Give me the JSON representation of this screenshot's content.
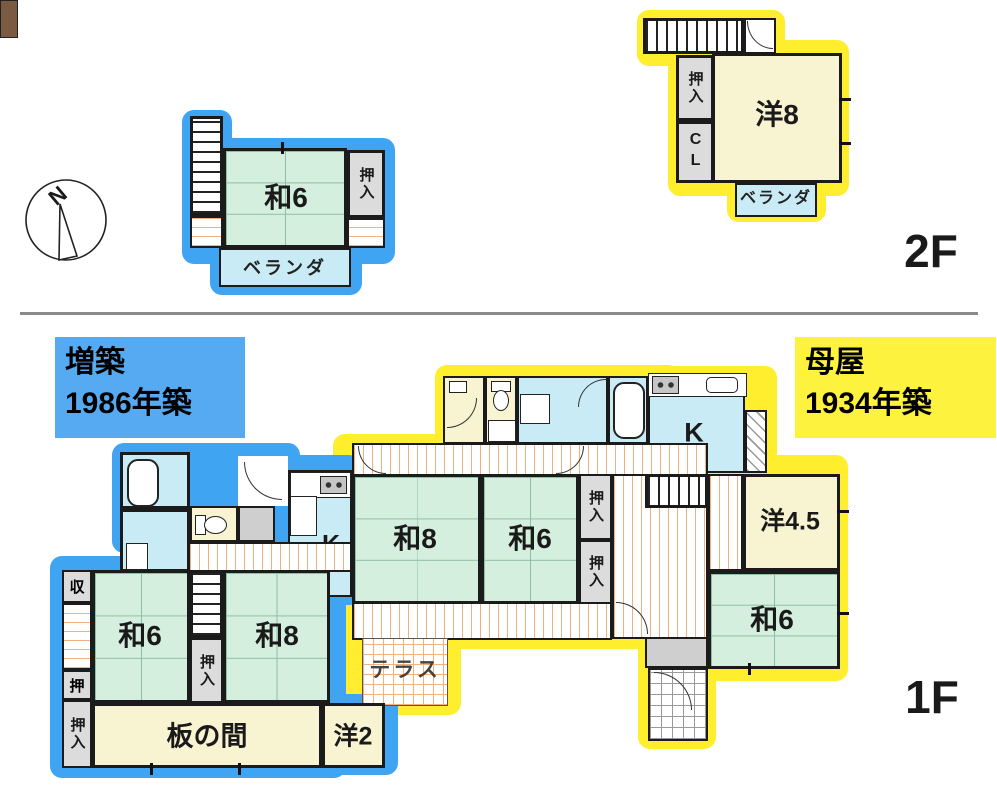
{
  "compass": {
    "north": "N"
  },
  "labels": {
    "floor2": "2F",
    "floor1": "1F"
  },
  "annotations": {
    "extension_line1": "増築",
    "extension_line2": "1986年築",
    "main_line1": "母屋",
    "main_line2": "1934年築"
  },
  "floor2": {
    "blue": {
      "room": "和6",
      "closet": "押入",
      "veranda": "ベランダ"
    },
    "yellow": {
      "room": "洋8",
      "closet": "押入",
      "cl": "CL",
      "veranda": "ベランダ"
    }
  },
  "floor1": {
    "blue": {
      "k": "K",
      "wa6": "和6",
      "wa8": "和8",
      "itanoma": "板の間",
      "yo2": "洋2",
      "shu": "収",
      "oshi": "押",
      "oshiire_left": "押入",
      "oshiire_stairs": "押入"
    },
    "yellow": {
      "k": "K",
      "wa8": "和8",
      "wa6_center": "和6",
      "wa6_se": "和6",
      "yo45": "洋4.5",
      "oshiire_upper": "押入",
      "oshiire_lower": "押入",
      "terrace": "テラス"
    }
  },
  "colors": {
    "extension_outline": "#3fa5f2",
    "main_outline": "#ffee2e",
    "extension_label_bg": "#56aaf2",
    "main_label_bg": "#fdf23d",
    "tatami_green": "#d5efde",
    "room_cream": "#f8f3d0",
    "water_blue": "#c9ebf6",
    "closet_gray": "#dcdcdc",
    "step_brown": "#7a5a40"
  }
}
